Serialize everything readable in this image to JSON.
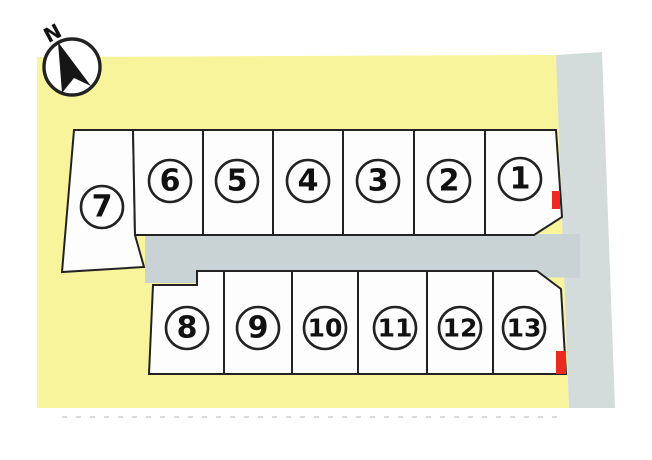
{
  "diagram": {
    "type": "land-plot-layout",
    "compass": {
      "label": "N"
    },
    "plots": {
      "top_row": [
        "7",
        "6",
        "5",
        "4",
        "3",
        "2",
        "1"
      ],
      "bottom_row": [
        "8",
        "9",
        "10",
        "11",
        "12",
        "13"
      ]
    },
    "markers": [
      {
        "plot": "1"
      },
      {
        "plot": "13"
      }
    ],
    "colors": {
      "site_yellow": "#f8f49b",
      "road_gray": "#c9d3d5",
      "road_right_gray": "#d3dbdb",
      "plot_fill": "#fdfdfd",
      "line_dark": "#222222",
      "marker_red": "#ee2a20",
      "number_color": "#111111",
      "dash_gray": "#dadada"
    }
  }
}
